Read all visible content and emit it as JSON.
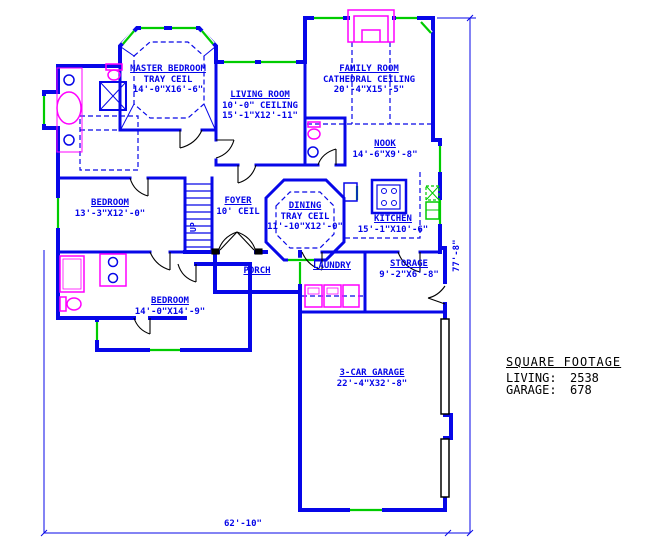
{
  "drawing": {
    "rooms": [
      {
        "name": "MASTER BEDROOM",
        "detail1": "TRAY CEIL",
        "detail2": "14'-0\"X16'-6\""
      },
      {
        "name": "LIVING ROOM",
        "detail1": "10'-0\" CEILING",
        "detail2": "15'-1\"X12'-11\""
      },
      {
        "name": "FAMILY ROOM",
        "detail1": "CATHEDRAL CEILING",
        "detail2": "20'-4\"X15'-5\""
      },
      {
        "name": "NOOK",
        "detail1": "14'-6\"X9'-8\""
      },
      {
        "name": "KITCHEN",
        "detail1": "15'-1\"X10'-6\""
      },
      {
        "name": "DINING",
        "detail1": "TRAY CEIL",
        "detail2": "11'-10\"X12'-0\""
      },
      {
        "name": "FOYER",
        "detail1": "10' CEIL"
      },
      {
        "name": "BEDROOM",
        "detail1": "13'-3\"X12'-0\""
      },
      {
        "name": "BEDROOM",
        "detail1": "14'-0\"X14'-9\""
      },
      {
        "name": "PORCH"
      },
      {
        "name": "LAUNDRY"
      },
      {
        "name": "STORAGE",
        "detail1": "9'-2\"X6'-8\""
      },
      {
        "name": "3-CAR GARAGE",
        "detail1": "22'-4\"X32'-8\""
      }
    ],
    "stairs": {
      "label": "UP"
    },
    "dimensions": {
      "overall_width": "62'-10\"",
      "overall_height": "77'-8\""
    },
    "square_footage": {
      "title": "SQUARE FOOTAGE",
      "rows": [
        {
          "label": "LIVING:",
          "value": "2538"
        },
        {
          "label": "GARAGE:",
          "value": "678"
        }
      ]
    },
    "colors": {
      "walls": "#0707e8",
      "windows": "#00cc00",
      "fixtures": "#ff00ff",
      "doors": "#000000",
      "room_text": "#0404e8",
      "footage_text": "#000000",
      "background": "#ffffff"
    }
  }
}
